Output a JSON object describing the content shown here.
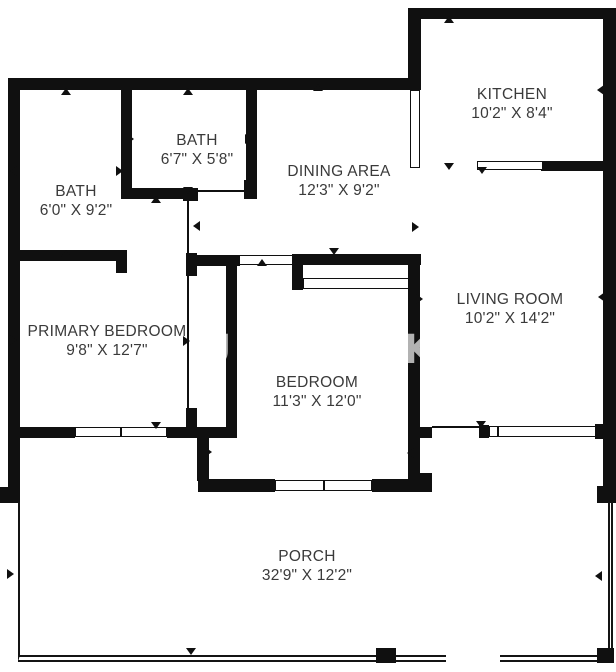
{
  "rooms": [
    {
      "id": "bath-1",
      "name": "BATH",
      "dims": "6'0\" X 9'2\""
    },
    {
      "id": "bath-2",
      "name": "BATH",
      "dims": "6'7\" X 5'8\""
    },
    {
      "id": "dining-area",
      "name": "DINING AREA",
      "dims": "12'3\" X 9'2\""
    },
    {
      "id": "kitchen",
      "name": "KITCHEN",
      "dims": "10'2\" X 8'4\""
    },
    {
      "id": "primary-bedroom",
      "name": "PRIMARY BEDROOM",
      "dims": "9'8\" X 12'7\""
    },
    {
      "id": "bedroom",
      "name": "BEDROOM",
      "dims": "11'3\" X 12'0\""
    },
    {
      "id": "living-room",
      "name": "LIVING ROOM",
      "dims": "10'2\" X 14'2\""
    },
    {
      "id": "porch",
      "name": "PORCH",
      "dims": "32'9\" X 12'2\""
    }
  ],
  "watermark_letters": [
    "U",
    "K"
  ],
  "colors": {
    "wall": "#101010",
    "background": "#ffffff",
    "label_text": "#3a3a3a"
  }
}
